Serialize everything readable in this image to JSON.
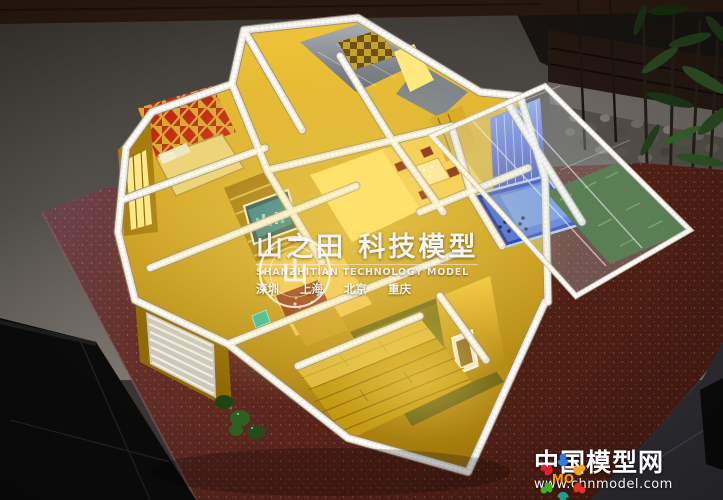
{
  "watermark_center": {
    "seal_glyph": "山",
    "title": "山之田 科技模型",
    "subtitle": "SHANZHITIAN TECHNOLOGY MODEL",
    "cities": "深圳  上海  北京  重庆"
  },
  "watermark_brand": {
    "logo_text": "MO",
    "site_name": "中国模型网",
    "site_url": "www.chnmodel.com"
  },
  "colors": {
    "gold": "#e8b82a",
    "crystal_white": "#eae5db",
    "pool_blue": "#2b3cc8",
    "terrace_green": "#3f7a28",
    "table_red": "#5a241c",
    "carpet_red": "#c42812",
    "brand_orange": "#f59a18"
  }
}
